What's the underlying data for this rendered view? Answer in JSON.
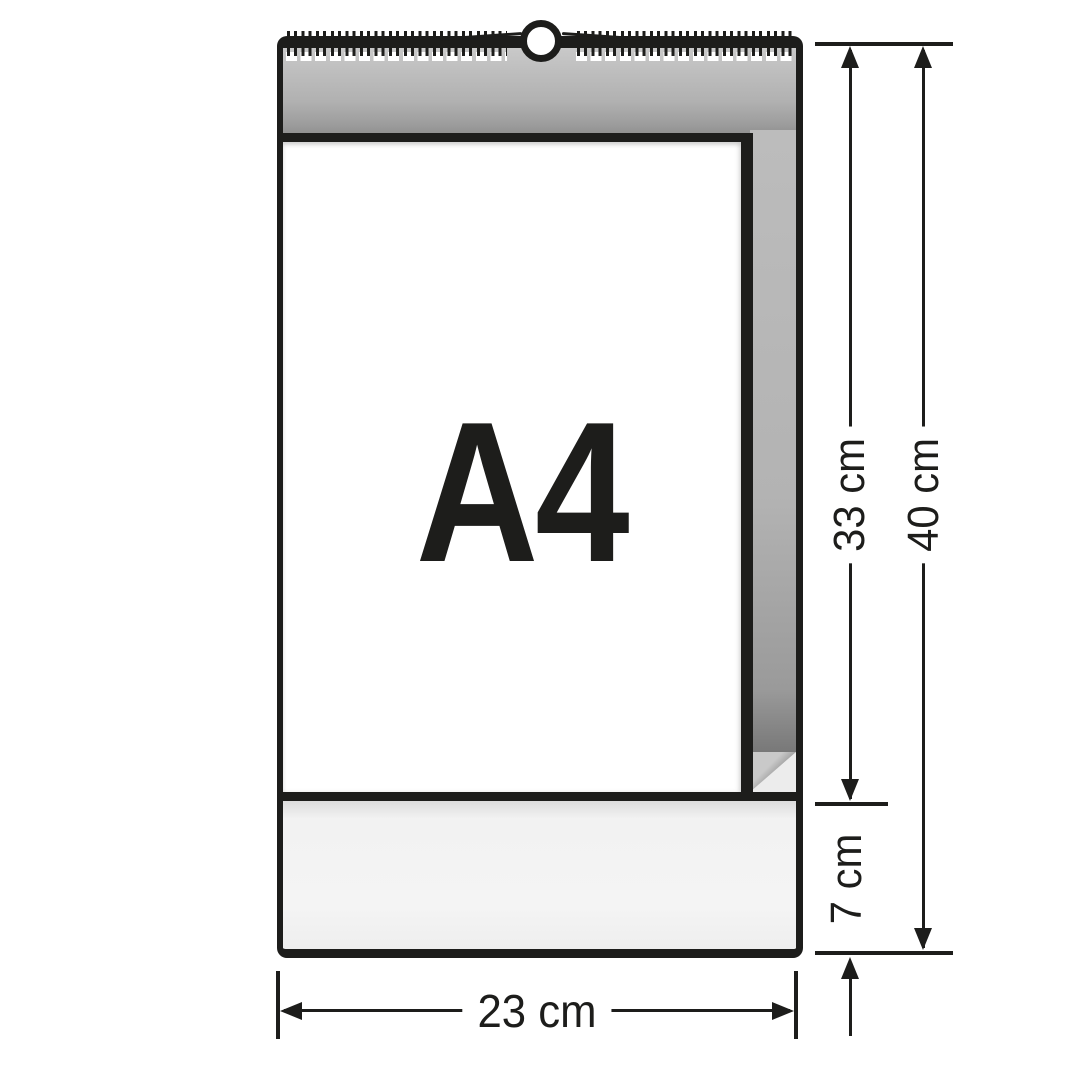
{
  "diagram": {
    "page_label": "A4",
    "dimensions": {
      "inner_height": "33 cm",
      "total_height": "40 cm",
      "footer_height": "7 cm",
      "width": "23 cm"
    },
    "colors": {
      "ink": "#1d1d1b",
      "back_board_gray": "#b3b3b3",
      "footer_light_gray": "#f3f3f3",
      "paper_white": "#ffffff"
    },
    "icons": [
      "spiral-binding-icon",
      "hanger-hole-icon",
      "page-curl-icon"
    ]
  }
}
